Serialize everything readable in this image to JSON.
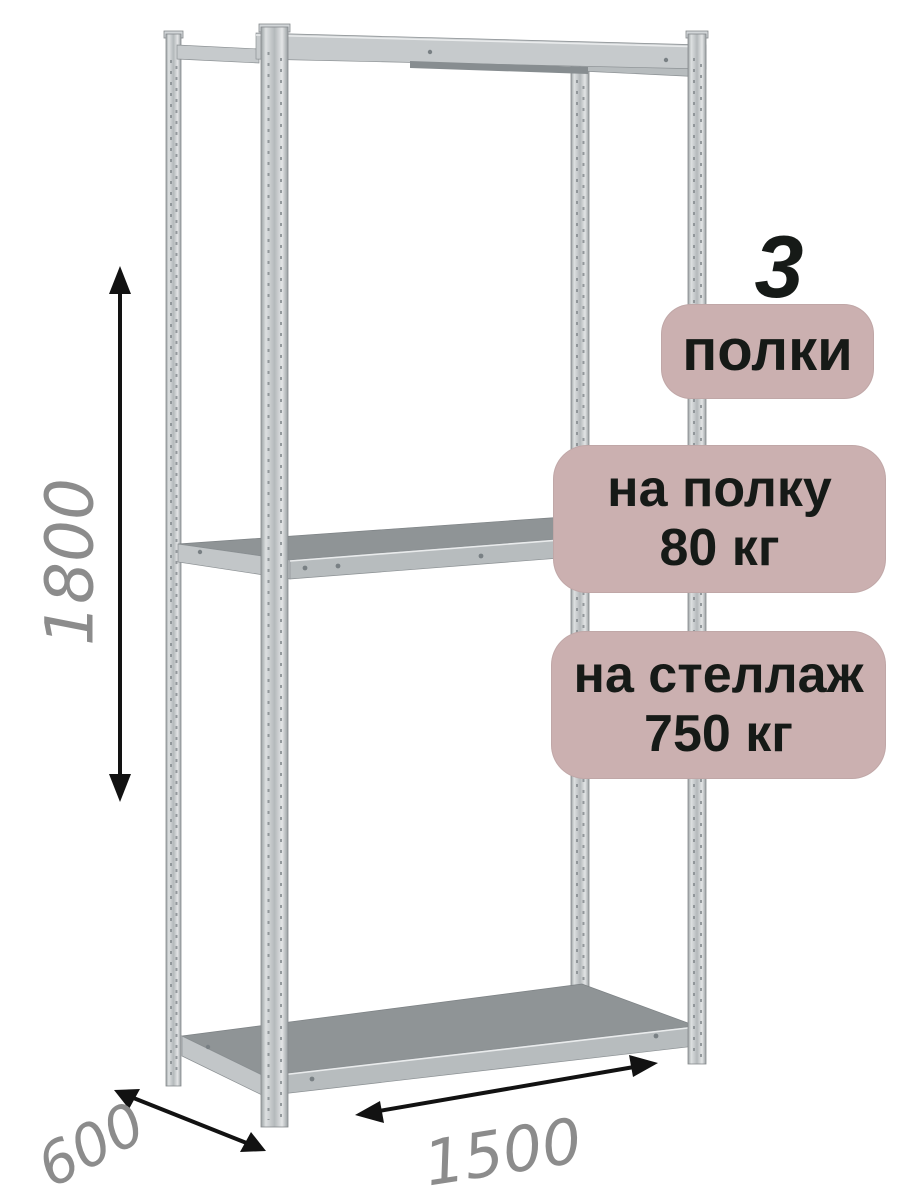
{
  "dimensions": {
    "height": "1800",
    "depth": "600",
    "width": "1500"
  },
  "badges": {
    "count_number": "3",
    "count_label": "полки",
    "shelf_load": {
      "line1": "на полку",
      "line2": "80 кг"
    },
    "rack_load": {
      "line1": "на стеллаж",
      "line2": "750 кг"
    }
  },
  "colors": {
    "badge_bg": "#cbb0b0",
    "badge_text": "#161a17",
    "dimension_text": "#8c8c8c",
    "arrow": "#121212",
    "metal_light": "#c6cacc",
    "metal_mid": "#b7bcbe",
    "metal_dark": "#878d90",
    "metal_shelf": "#8f9496"
  }
}
